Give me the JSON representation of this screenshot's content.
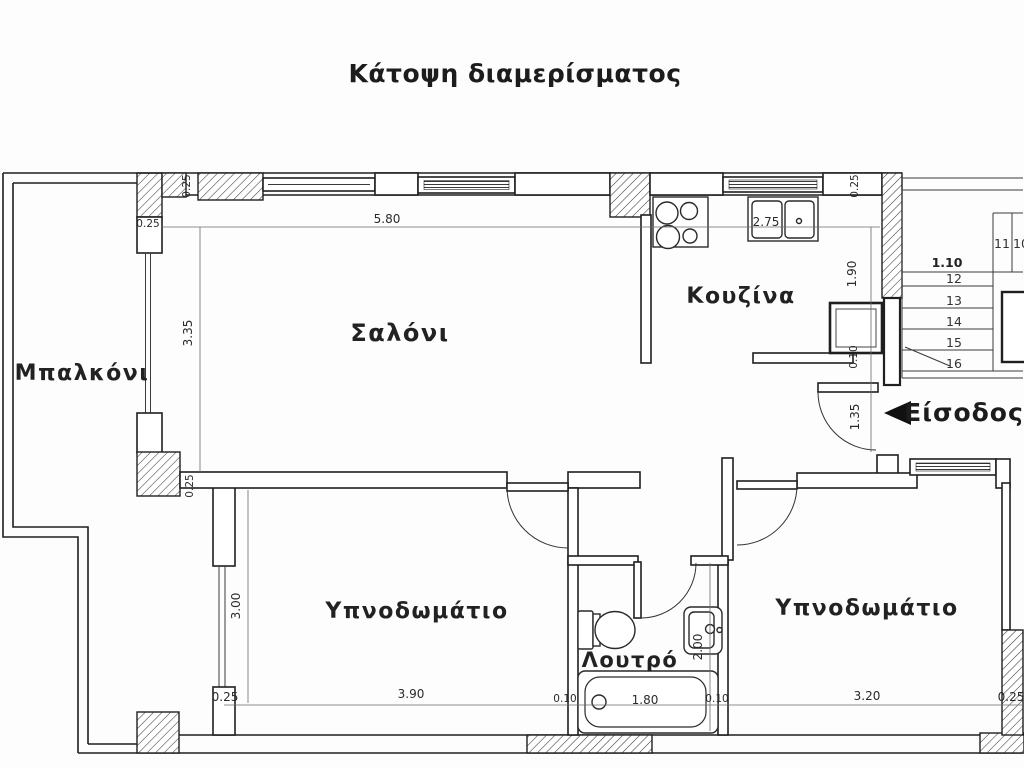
{
  "title": "Κάτοψη διαμερίσματος",
  "rooms": {
    "balcony": "Μπαλκόνι",
    "living_room": "Σαλόνι",
    "kitchen": "Κουζίνα",
    "bedroom_left": "Υπνοδωμάτιο",
    "bedroom_right": "Υπνοδωμάτιο",
    "bathroom": "Λουτρό",
    "entrance": "Είσοδος"
  },
  "dimensions": {
    "living_width": "5.80",
    "kitchen_width": "2.75",
    "stairs_width": "1.10",
    "living_depth": "3.35",
    "kitchen_depth": "1.90",
    "kitchen_wall": "0.10",
    "entrance_width": "1.35",
    "bedroom_left_depth": "3.00",
    "bedroom_left_width": "3.90",
    "bath_wall_left": "0.10",
    "bathtub_length": "1.80",
    "bath_wall_right": "0.10",
    "bedroom_right_width": "3.20",
    "bathroom_depth": "2.00",
    "wall_top_left": "0.25",
    "wall_left_jamb": "0.25",
    "wall_left_mid": "0.25",
    "wall_bottom_left": "0.25",
    "wall_top_right": "0.25",
    "wall_bottom_right": "0.25"
  },
  "stairs": {
    "step_numbers": [
      "11",
      "10",
      "12",
      "13",
      "14",
      "15",
      "16"
    ]
  },
  "icons": {
    "entrance_arrow": "left-filled-triangle"
  },
  "colors": {
    "background": "#fdfdfd",
    "line": "#1f1f1f",
    "text": "#1c1c1c"
  }
}
